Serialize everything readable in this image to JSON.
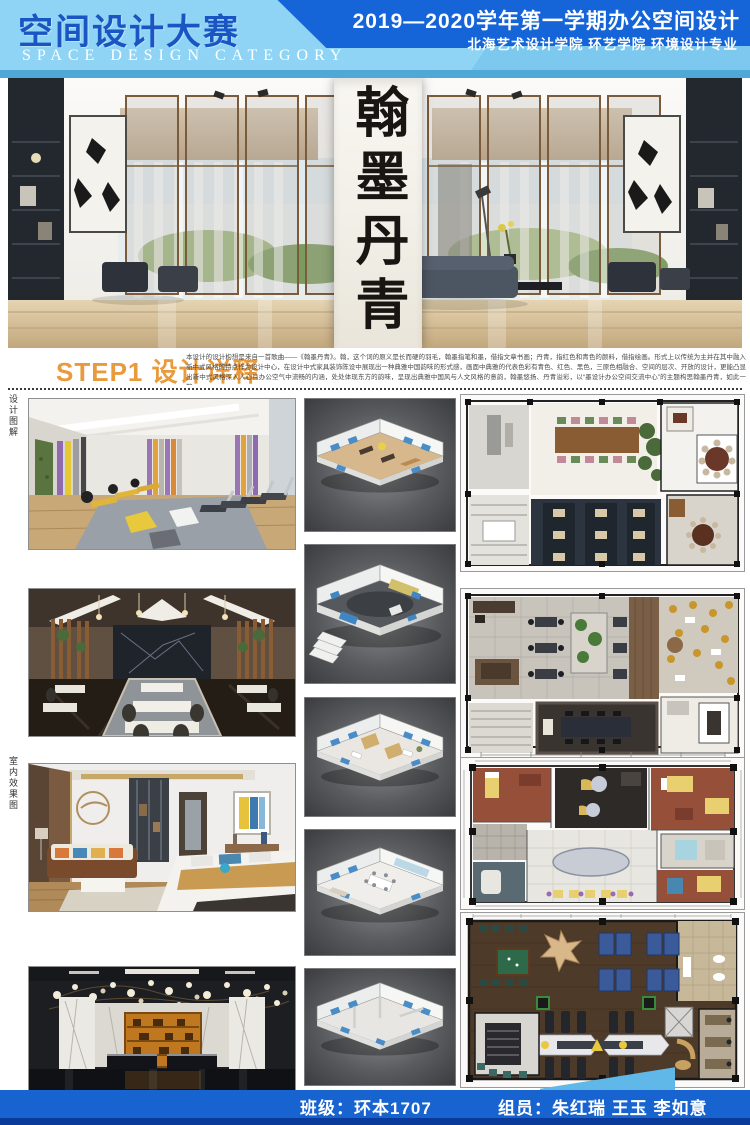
{
  "header": {
    "title_cn": "空间设计大赛",
    "title_en": "SPACE DESIGN CATEGORY",
    "term_line": "2019—2020学年第一学期办公空间设计",
    "school_line": "北海艺术设计学院  环艺学院  环境设计专业"
  },
  "hero": {
    "calligraphy": "翰墨丹青"
  },
  "step1": {
    "heading": "STEP1 设计详释",
    "paragraph": "本设计的设计构想是来自一首歌曲——《翰墨丹青》。翰，这个词的原义是长而硬的羽毛，翰墨指笔和墨，借指文章书画；丹青，指红色和青色的颜料，借指绘画。形式上以传统为主并在其中融入新中式风格的特点作为设计中心，在设计中式家具装饰陈设中展现出一种典雅中国韵味的形式感，画面中典雅的代表色彩有青色、红色、黑色，三原色相融合、空间的层次、开放的设计，更能凸显出新中式风格深入人心且办公空气中流畅的内涵，处处体现东方的韵味，呈现出典雅中国风与人文风格的意韵，翰墨悠扬、丹青溢彩，以“墨设计办公空间交流中心”的主题构思翰墨丹青，如此一瞥。"
  },
  "side_labels": {
    "top": "设计图解",
    "bottom": "室内效果图"
  },
  "gallery": {
    "left_images": [
      "gym-render",
      "dining-hall-render",
      "bedroom-render",
      "lobby-render"
    ],
    "middle_models": [
      "axon-model-1",
      "axon-model-2",
      "axon-model-3",
      "axon-model-4",
      "axon-model-5"
    ],
    "right_plans": [
      "restaurant-floor-plan",
      "office-floor-plan",
      "guestroom-floor-plan",
      "gym-floor-plan"
    ]
  },
  "footer": {
    "class_label": "班级：环本1707",
    "members_label": "组员：朱红瑞  王玉  李如意"
  },
  "colors": {
    "header_light_blue": "#8FD4F4",
    "header_dark_blue": "#1565D8",
    "header_title_blue": "#1A55C4",
    "header_strip_blue": "#4FA8D6",
    "step_accent_orange": "#E89A3C",
    "footer_blue": "#1763CF",
    "footer_navy": "#0A3A9A",
    "footer_accent": "#5FB8E8"
  }
}
